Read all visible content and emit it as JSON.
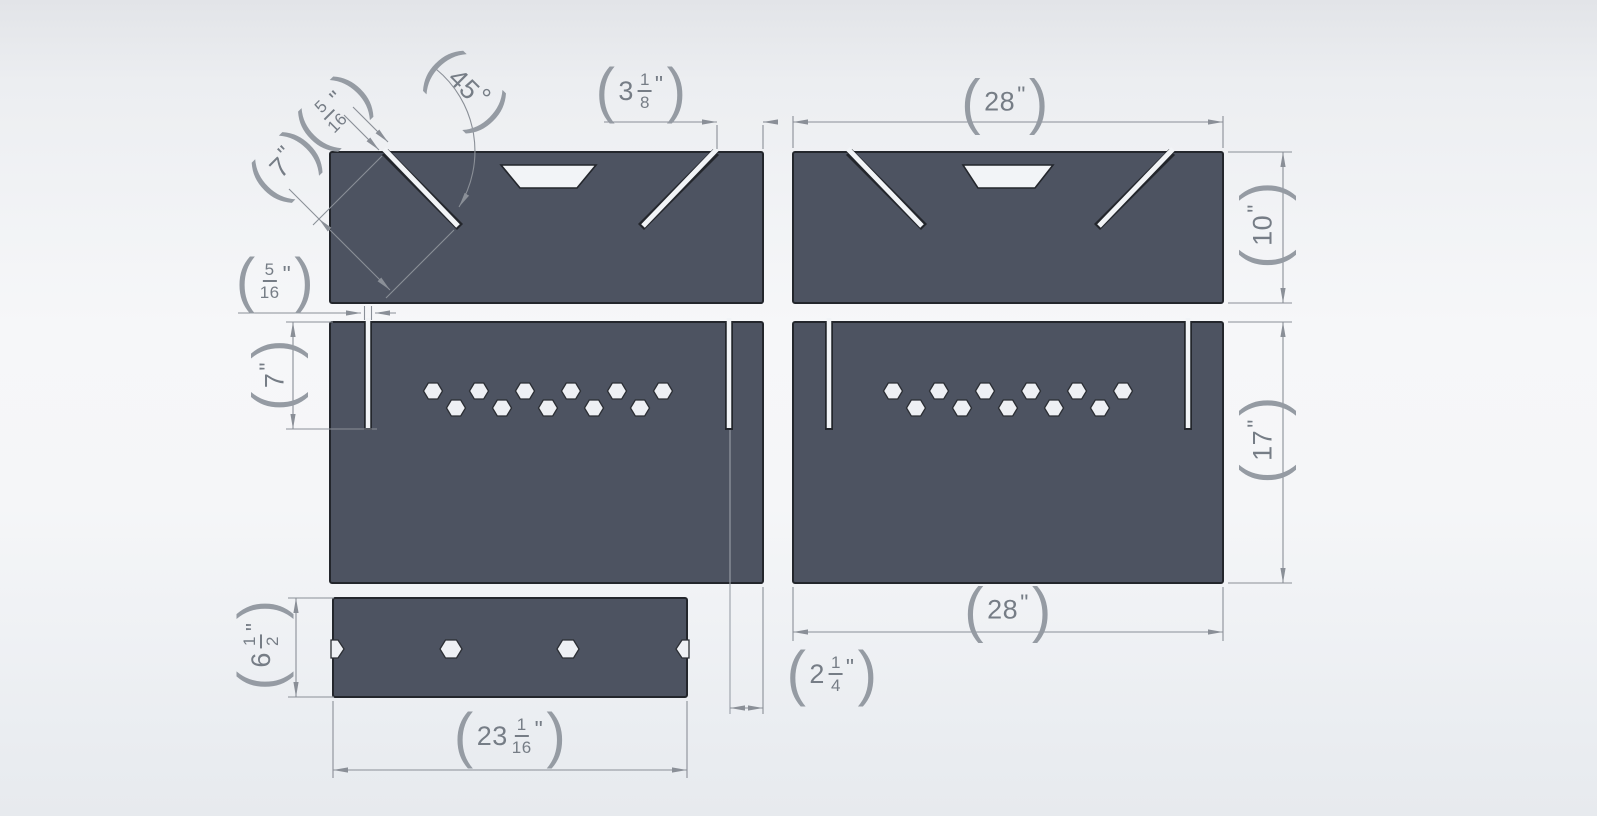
{
  "punct": {
    "open": "(",
    "close": ")"
  },
  "dimensions": {
    "top_slot_width": {
      "num": "5",
      "den": "16",
      "unit": "\""
    },
    "top_slot_angle": {
      "value": "45",
      "unit": "°"
    },
    "top_slot_length": {
      "value": "7",
      "unit": "\""
    },
    "top_slot_edge_offset": {
      "whole": "3",
      "num": "1",
      "den": "8",
      "unit": "\""
    },
    "top_panel_width": {
      "value": "28",
      "unit": "\""
    },
    "top_panel_height": {
      "value": "10",
      "unit": "\""
    },
    "mid_slot_width": {
      "num": "5",
      "den": "16",
      "unit": "\""
    },
    "mid_slot_length": {
      "value": "7",
      "unit": "\""
    },
    "mid_panel_height": {
      "value": "17",
      "unit": "\""
    },
    "mid_panel_width": {
      "value": "28",
      "unit": "\""
    },
    "mid_slot_edge_offset": {
      "whole": "2",
      "num": "1",
      "den": "4",
      "unit": "\""
    },
    "brace_height": {
      "whole": "6",
      "num": "1",
      "den": "2",
      "unit": "\""
    },
    "brace_width": {
      "whole": "23",
      "num": "1",
      "den": "16",
      "unit": "\""
    }
  },
  "colors": {
    "panel_fill": "#4d5361",
    "panel_edge": "#23262c",
    "hole_fill": "#f2f4f7",
    "dim_line": "#8a8f97",
    "dim_text": "#767d86",
    "background_top": "#e2e4e8",
    "background_mid": "#f6f7f9"
  }
}
